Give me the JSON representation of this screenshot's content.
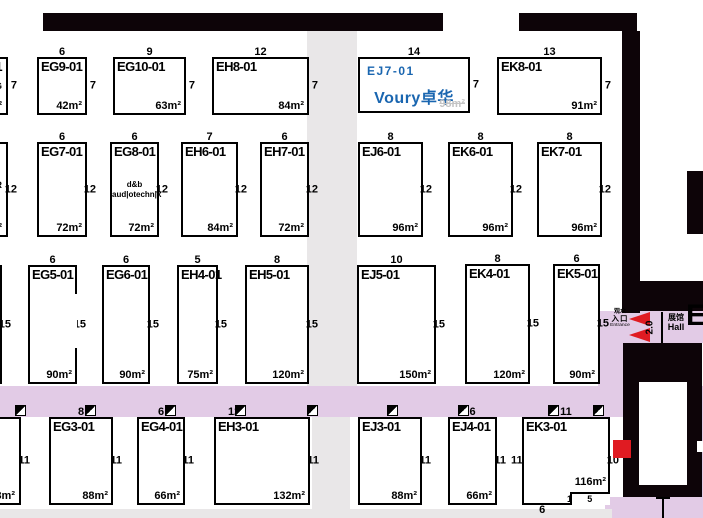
{
  "colors": {
    "wall": "#0d0408",
    "purple": "#e2cbe6",
    "gray": "#e9e7e8",
    "red": "#e01b22",
    "blue": "#1a66b0"
  },
  "corridor": {
    "entrance": [
      "观众",
      "入口",
      "Entrance"
    ],
    "gate_width": "2.0",
    "hall_cn": "展馆",
    "hall_en": "Hall",
    "hall_letter": "E"
  },
  "booths": [
    {
      "code": "1",
      "extra": "NG",
      "right": "7",
      "area": "m²",
      "x": -28,
      "y": 57,
      "w": 36,
      "h": 58
    },
    {
      "code": "EG9-01",
      "top": "6",
      "right": "7",
      "area": "42m²",
      "x": 37,
      "y": 57,
      "w": 50,
      "h": 58
    },
    {
      "code": "EG10-01",
      "top": "9",
      "right": "7",
      "area": "63m²",
      "x": 113,
      "y": 57,
      "w": 73,
      "h": 58
    },
    {
      "code": "EH8-01",
      "top": "12",
      "right": "7",
      "area": "84m²",
      "x": 212,
      "y": 57,
      "w": 97,
      "h": 58
    },
    {
      "code": "EJ7-01",
      "blue": true,
      "logo": "Voury卓华",
      "top": "14",
      "right": "7",
      "area": "98m²",
      "faint": true,
      "x": 358,
      "y": 57,
      "w": 112,
      "h": 56
    },
    {
      "code": "EK8-01",
      "top": "13",
      "right": "7",
      "area": "91m²",
      "x": 497,
      "y": 57,
      "w": 105,
      "h": 58
    },
    {
      "extra": "ER",
      "right": "12",
      "area": "m²",
      "x": -28,
      "y": 142,
      "w": 36,
      "h": 95
    },
    {
      "code": "EG7-01",
      "top": "6",
      "right": "12",
      "area": "72m²",
      "x": 37,
      "y": 142,
      "w": 50,
      "h": 95
    },
    {
      "code": "EG8-01",
      "extra": "d&b\naud|otechn|k",
      "top": "6",
      "right": "12",
      "area": "72m²",
      "x": 110,
      "y": 142,
      "w": 49,
      "h": 95
    },
    {
      "code": "EH6-01",
      "top": "7",
      "right": "12",
      "area": "84m²",
      "x": 181,
      "y": 142,
      "w": 57,
      "h": 95
    },
    {
      "code": "EH7-01",
      "top": "6",
      "right": "12",
      "area": "72m²",
      "x": 260,
      "y": 142,
      "w": 49,
      "h": 95
    },
    {
      "code": "EJ6-01",
      "top": "8",
      "right": "12",
      "area": "96m²",
      "x": 358,
      "y": 142,
      "w": 65,
      "h": 95
    },
    {
      "code": "EK6-01",
      "top": "8",
      "right": "12",
      "area": "96m²",
      "x": 448,
      "y": 142,
      "w": 65,
      "h": 95
    },
    {
      "code": "EK7-01",
      "top": "8",
      "right": "12",
      "area": "96m²",
      "x": 537,
      "y": 142,
      "w": 65,
      "h": 95
    },
    {
      "right": "15",
      "area": "m²",
      "x": -30,
      "y": 265,
      "w": 32,
      "h": 119
    },
    {
      "code": "EG5-01",
      "top": "6",
      "right": "15",
      "area": "90m²",
      "x": 28,
      "y": 265,
      "w": 49,
      "h": 119,
      "gap_right": true
    },
    {
      "code": "EG6-01",
      "top": "6",
      "right": "15",
      "area": "90m²",
      "x": 102,
      "y": 265,
      "w": 48,
      "h": 119
    },
    {
      "code": "EH4-01",
      "top": "5",
      "right": "15",
      "area": "75m²",
      "x": 177,
      "y": 265,
      "w": 41,
      "h": 119
    },
    {
      "code": "EH5-01",
      "top": "8",
      "right": "15",
      "area": "120m²",
      "x": 245,
      "y": 265,
      "w": 64,
      "h": 119
    },
    {
      "code": "EJ5-01",
      "top": "10",
      "right": "15",
      "area": "150m²",
      "x": 357,
      "y": 265,
      "w": 79,
      "h": 119
    },
    {
      "code": "EK4-01",
      "top": "8",
      "right": "15",
      "area": "120m²",
      "x": 465,
      "y": 264,
      "w": 65,
      "h": 120
    },
    {
      "code": "EK5-01",
      "top": "6",
      "right": "15",
      "area": "90m²",
      "x": 553,
      "y": 264,
      "w": 47,
      "h": 120
    },
    {
      "right": "11",
      "area": "88m²",
      "x": -30,
      "y": 417,
      "w": 51,
      "h": 88
    },
    {
      "code": "EG3-01",
      "top": "8",
      "right": "11",
      "area": "88m²",
      "x": 49,
      "y": 417,
      "w": 64,
      "h": 88
    },
    {
      "code": "EG4-01",
      "top": "6",
      "right": "11",
      "area": "66m²",
      "x": 137,
      "y": 417,
      "w": 48,
      "h": 88
    },
    {
      "code": "EH3-01",
      "top": "12",
      "top_pos": "left",
      "right": "11",
      "area": "132m²",
      "x": 214,
      "y": 417,
      "w": 96,
      "h": 88
    },
    {
      "code": "EJ3-01",
      "top": "8",
      "right": "11",
      "area": "88m²",
      "x": 358,
      "y": 417,
      "w": 64,
      "h": 88
    },
    {
      "code": "EJ4-01",
      "top": "6",
      "right": "11",
      "area": "66m²",
      "x": 448,
      "y": 417,
      "w": 49,
      "h": 88
    },
    {
      "code": "EK3-01",
      "top": "11",
      "left": "11",
      "right": "10",
      "bottom": "6",
      "area": "116m²",
      "x": 522,
      "y": 417,
      "w": 88,
      "h": 88,
      "notch": {
        "w": 40,
        "h": 13,
        "v": "1",
        "hl": "5"
      }
    }
  ],
  "pillars": {
    "y": 405,
    "xs": [
      15,
      85,
      165,
      235,
      307,
      387,
      458,
      548,
      593
    ]
  },
  "zones": [
    {
      "type": "aisle-gray",
      "x": 307,
      "y": 31,
      "w": 50,
      "h": 355
    },
    {
      "type": "aisle-gray",
      "x": 312,
      "y": 417,
      "w": 38,
      "h": 92
    },
    {
      "type": "aisle-gray",
      "x": 0,
      "y": 509,
      "w": 612,
      "h": 9
    },
    {
      "type": "aisle-purple",
      "x": 0,
      "y": 386,
      "w": 624,
      "h": 31
    },
    {
      "type": "aisle-purple",
      "x": 598,
      "y": 311,
      "w": 105,
      "h": 32
    },
    {
      "type": "aisle-purple",
      "x": 598,
      "y": 343,
      "w": 26,
      "h": 43
    },
    {
      "type": "aisle-purple",
      "x": 605,
      "y": 497,
      "w": 98,
      "h": 21
    },
    {
      "type": "aisle-purple",
      "x": 699,
      "y": 386,
      "w": 4,
      "h": 111
    }
  ],
  "walls": [
    {
      "x": 43,
      "y": 13,
      "w": 400,
      "h": 18
    },
    {
      "x": 519,
      "y": 13,
      "w": 118,
      "h": 18
    },
    {
      "x": 622,
      "y": 31,
      "w": 18,
      "h": 282
    },
    {
      "x": 687,
      "y": 171,
      "w": 16,
      "h": 63
    },
    {
      "x": 628,
      "y": 281,
      "w": 75,
      "h": 30
    },
    {
      "x": 623,
      "y": 343,
      "w": 79,
      "h": 154
    }
  ],
  "wall_holes": [
    {
      "x": 639,
      "y": 382,
      "w": 48,
      "h": 103
    },
    {
      "x": 697,
      "y": 441,
      "w": 6,
      "h": 11
    }
  ]
}
